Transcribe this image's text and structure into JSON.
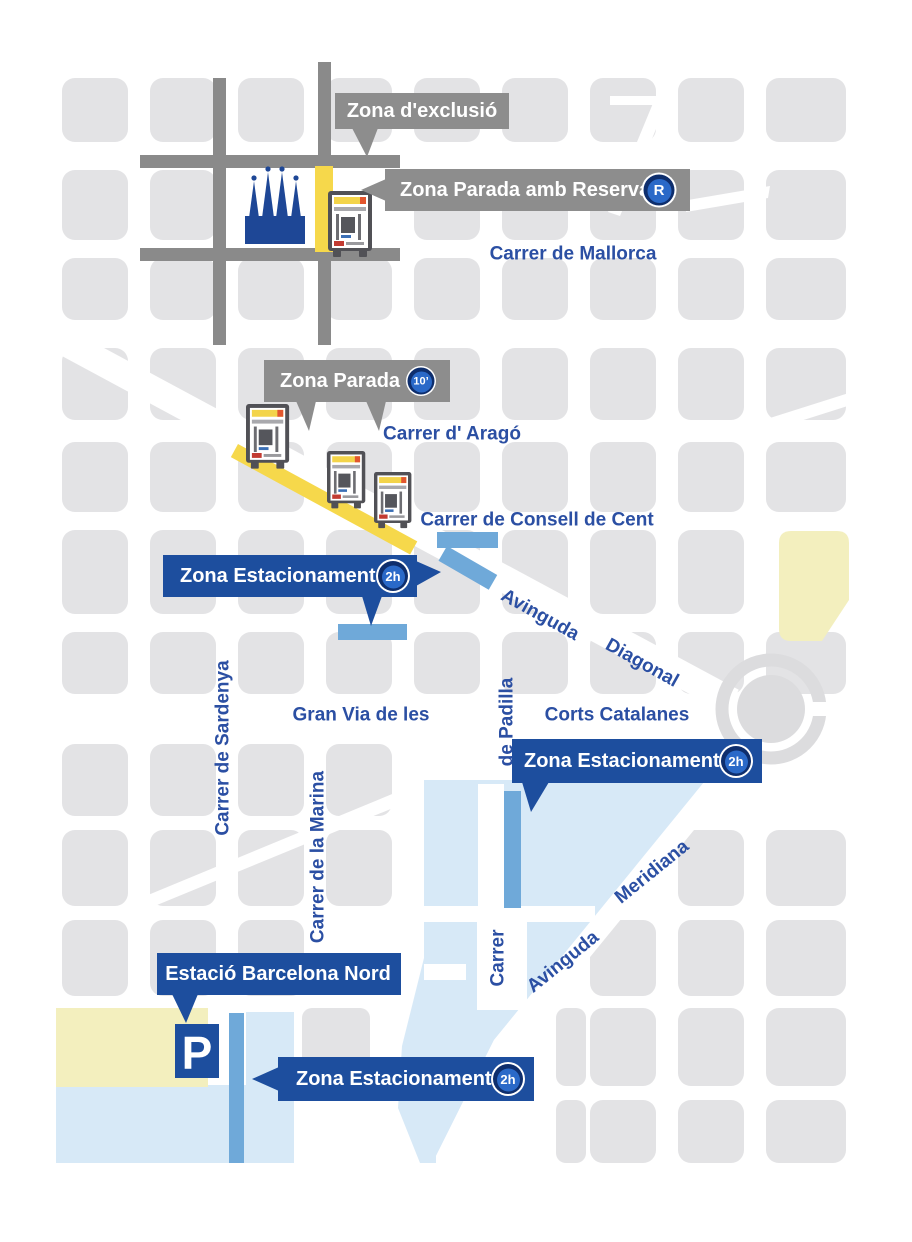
{
  "colors": {
    "background": "#ffffff",
    "city_block": "#e3e3e5",
    "exclusion_road": "#8a8a8a",
    "gray_callout": "#8d8d8d",
    "blue_callout": "#1d4e9e",
    "street_label": "#2b4fa3",
    "parada_yellow": "#f6d84b",
    "zone_pale_yellow": "#f3efbe",
    "zone_light_blue": "#d7e9f7",
    "estacionament_strip": "#6fa9d9",
    "badge_ring": "#0e2e6d",
    "badge_fill": "#2a69c8",
    "sagrada_blue": "#1e4796"
  },
  "callouts": {
    "exclusio": {
      "label": "Zona d'exclusió"
    },
    "parada_reserva": {
      "label": "Zona Parada amb Reserva",
      "badge": "R"
    },
    "parada": {
      "label": "Zona Parada",
      "badge": "10’"
    },
    "estacionament_diagonal": {
      "label": "Zona Estacionament",
      "badge": "2h"
    },
    "estacionament_glories": {
      "label": "Zona Estacionament",
      "badge": "2h"
    },
    "estacionament_estacio": {
      "label": "Zona Estacionament",
      "badge": "2h"
    },
    "estacio_nord": {
      "label": "Estació Barcelona Nord"
    }
  },
  "streets": {
    "mallorca": "Carrer de Mallorca",
    "arago": "Carrer  d' Aragó",
    "consell": "Carrer de Consell de Cent",
    "diagonal_word1": "Avinguda",
    "diagonal_word2": "Diagonal",
    "gran_via": "Gran Via de les",
    "corts": "Corts Catalanes",
    "padilla": "de Padilla",
    "carrer": "Carrer",
    "meridiana_word1": "Avinguda",
    "meridiana_word2": "Meridiana",
    "sardenya": "Carrer de Sardenya",
    "marina": "Carrer de la Marina"
  },
  "icons": {
    "parking": "P"
  }
}
